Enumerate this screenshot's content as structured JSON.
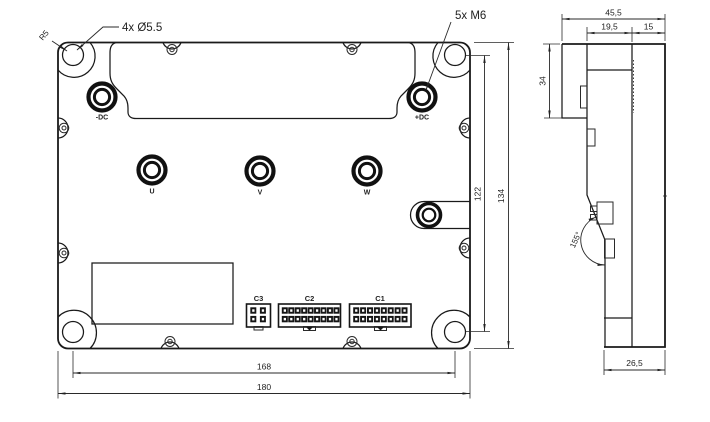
{
  "drawing": {
    "callouts": {
      "corner_radius": "R5",
      "mounting_holes": "4x Ø5.5",
      "terminal_thread": "5x M6"
    },
    "front_view": {
      "terminals": {
        "dc_neg": "-DC",
        "dc_pos": "+DC",
        "phase_u": "U",
        "phase_v": "V",
        "phase_w": "W"
      },
      "connectors": [
        {
          "label": "C3",
          "pin_layout": "2x2"
        },
        {
          "label": "C2",
          "pin_layout": "2x9"
        },
        {
          "label": "C1",
          "pin_layout": "2x8"
        }
      ],
      "dimensions": {
        "mount_hole_spacing_v": "122",
        "overall_height": "134",
        "mount_hole_spacing_h": "168",
        "overall_width": "180"
      }
    },
    "side_view": {
      "dimensions": {
        "overall_depth": "45,5",
        "cover_depth": "19,5",
        "body_depth": "15",
        "terminal_block_height": "34",
        "base_width": "26,5",
        "bend_angle": "155°"
      }
    }
  }
}
